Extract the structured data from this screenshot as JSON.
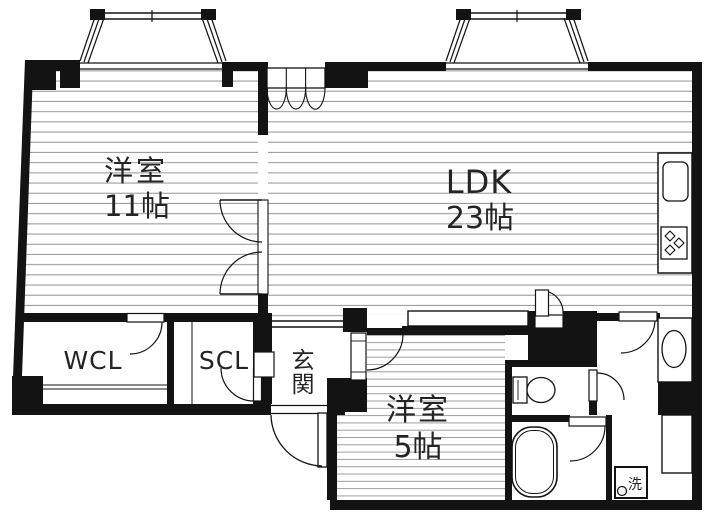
{
  "plan": {
    "type": "japanese-apartment-floor-plan",
    "colors": {
      "wall": "#131313",
      "hatch_line": "#9c9c9c",
      "text": "#242424",
      "bg": "#ffffff"
    },
    "rooms": {
      "western11": {
        "name": "洋室",
        "size": "11帖"
      },
      "ldk": {
        "name": "LDK",
        "size": "23帖"
      },
      "wcl": {
        "name": "WCL"
      },
      "scl": {
        "name": "SCL"
      },
      "genkan": {
        "char1": "玄",
        "char2": "関"
      },
      "western5": {
        "name": "洋室",
        "size": "5帖"
      },
      "laundry": {
        "label": "洗"
      }
    },
    "fixtures": [
      "bay-window-left",
      "bay-window-right",
      "kitchen-counter",
      "kitchen-sink",
      "gas-stove",
      "wash-basin",
      "toilet",
      "bathtub",
      "washing-machine-pan",
      "closet-bifold",
      "closet-sliding",
      "entrance-door"
    ]
  }
}
